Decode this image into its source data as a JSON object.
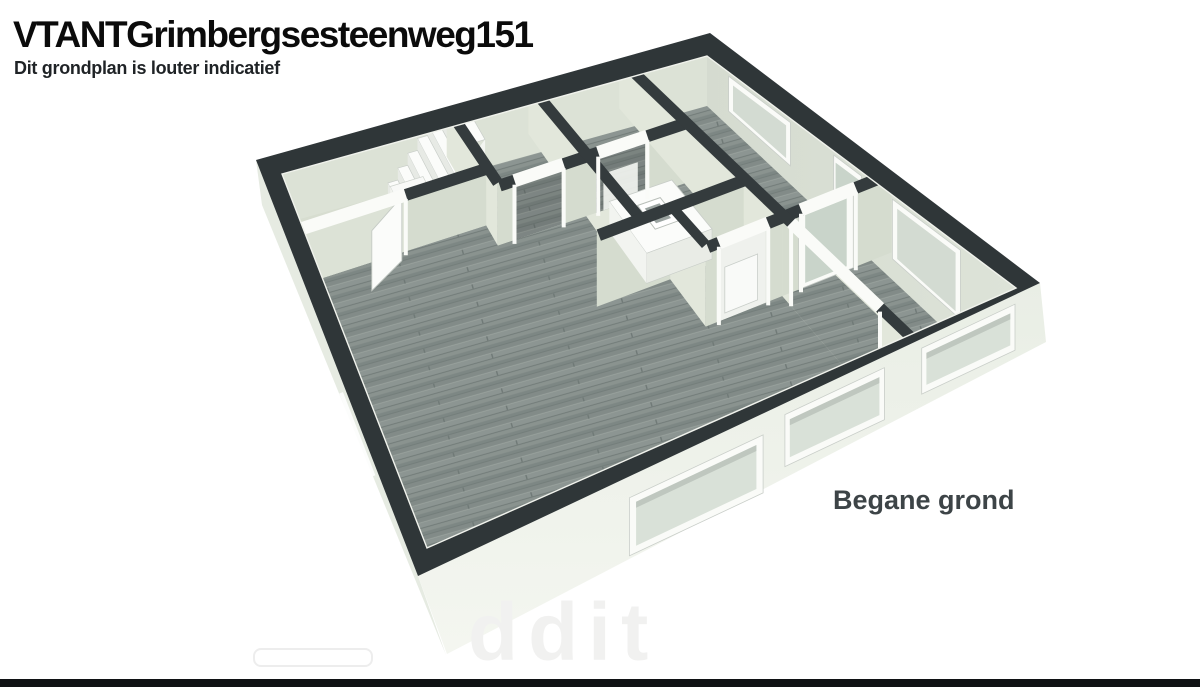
{
  "header": {
    "title": "VTANTGrimbergsesteenweg151",
    "subtitle": "Dit grondplan is louter indicatief"
  },
  "plan": {
    "floor_label": "Begane grond",
    "watermark": "ddit"
  },
  "colors": {
    "rim_charcoal": "#2f3638",
    "wall_band": "#343b3d",
    "face_v": "#d5dccf",
    "face_u": "#e2e7db",
    "facade_nw": "#dce2d6",
    "facade_ne_a": "#d5dbd0",
    "facade_ne_b": "#dde3d8",
    "wood_base": "#868f8c",
    "sage_floor": "#d7ddd0",
    "frame_white": "#fafbf8",
    "glass": "#d3dbd2",
    "exterior_a": "#e9eee5",
    "exterior_b": "#f4f6f0",
    "exterior_left": "#e6ebe2",
    "label_gray": "#3d4447"
  }
}
